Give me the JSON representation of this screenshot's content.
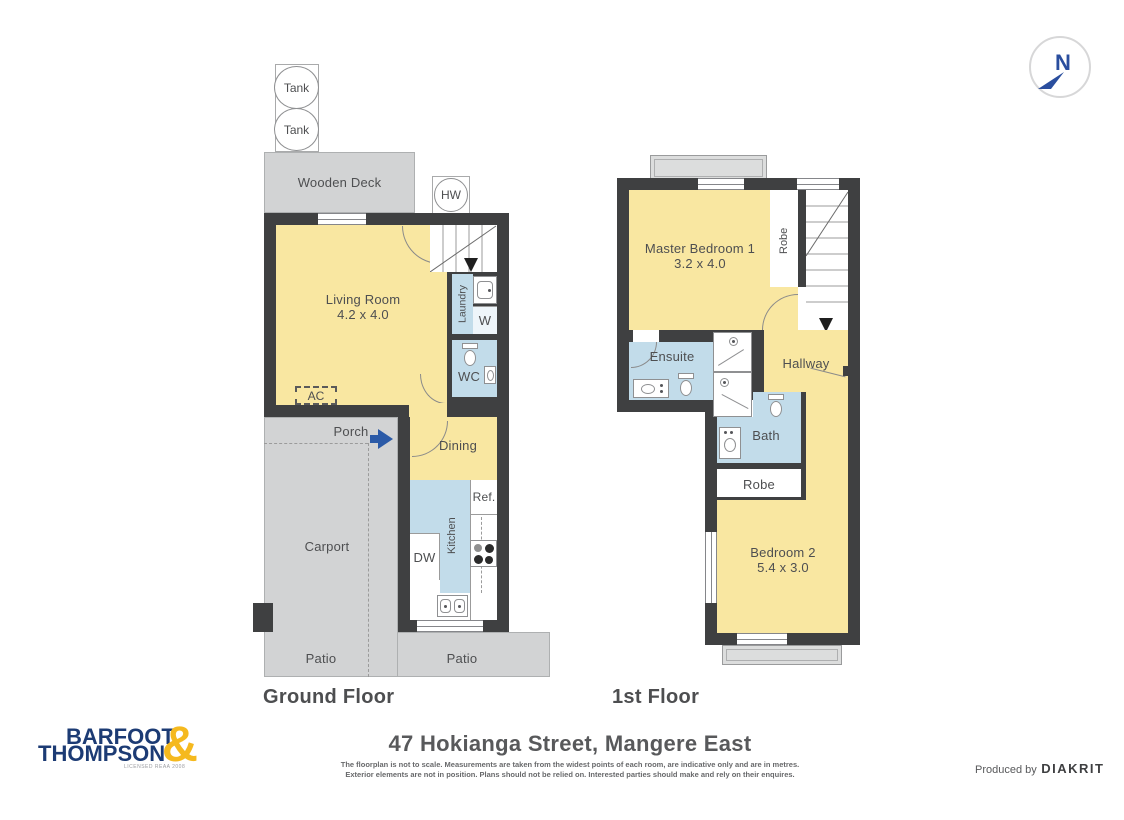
{
  "colors": {
    "wall": "#3f4041",
    "room_yellow": "#f9e7a1",
    "room_blue": "#c2dcea",
    "outdoor_gray": "#d2d3d4",
    "entry_arrow_blue": "#2b5aa7",
    "logo_navy": "#1c3b74",
    "logo_gold": "#f5b91e",
    "north_navy": "#2a4e9e"
  },
  "north": {
    "label": "N"
  },
  "ground_floor": {
    "floor_label": "Ground Floor",
    "tank_1": "Tank",
    "tank_2": "Tank",
    "wooden_deck": "Wooden Deck",
    "hot_water": "HW",
    "living_room_name": "Living Room",
    "living_room_dims": "4.2 x 4.0",
    "laundry": "Laundry",
    "washer": "W",
    "wc": "WC",
    "ac": "AC",
    "porch": "Porch",
    "dining": "Dining",
    "fridge": "Ref.",
    "kitchen": "Kitchen",
    "dishwasher": "DW",
    "carport": "Carport",
    "patio_left": "Patio",
    "patio_right": "Patio"
  },
  "first_floor": {
    "floor_label": "1st Floor",
    "master_bedroom_name": "Master Bedroom 1",
    "master_bedroom_dims": "3.2 x 4.0",
    "robe_master": "Robe",
    "ensuite": "Ensuite",
    "hallway": "Hallway",
    "bath": "Bath",
    "robe_hall": "Robe",
    "bedroom2_name": "Bedroom 2",
    "bedroom2_dims": "5.4 x 3.0"
  },
  "footer": {
    "address": "47 Hokianga Street, Mangere East",
    "disclaimer_line1": "The floorplan is not to scale. Measurements are taken from the widest points of each room, are indicative only and are in metres.",
    "disclaimer_line2": "Exterior elements are not in position. Plans should not be relied on. Interested parties should make and rely on their enquires.",
    "produced_by": "Produced by",
    "producer": "DIAKRIT"
  },
  "logo": {
    "word1": "BARFOOT",
    "word2": "THOMPSON",
    "ampersand": "&",
    "tagline": "LICENSED REAA 2008"
  }
}
